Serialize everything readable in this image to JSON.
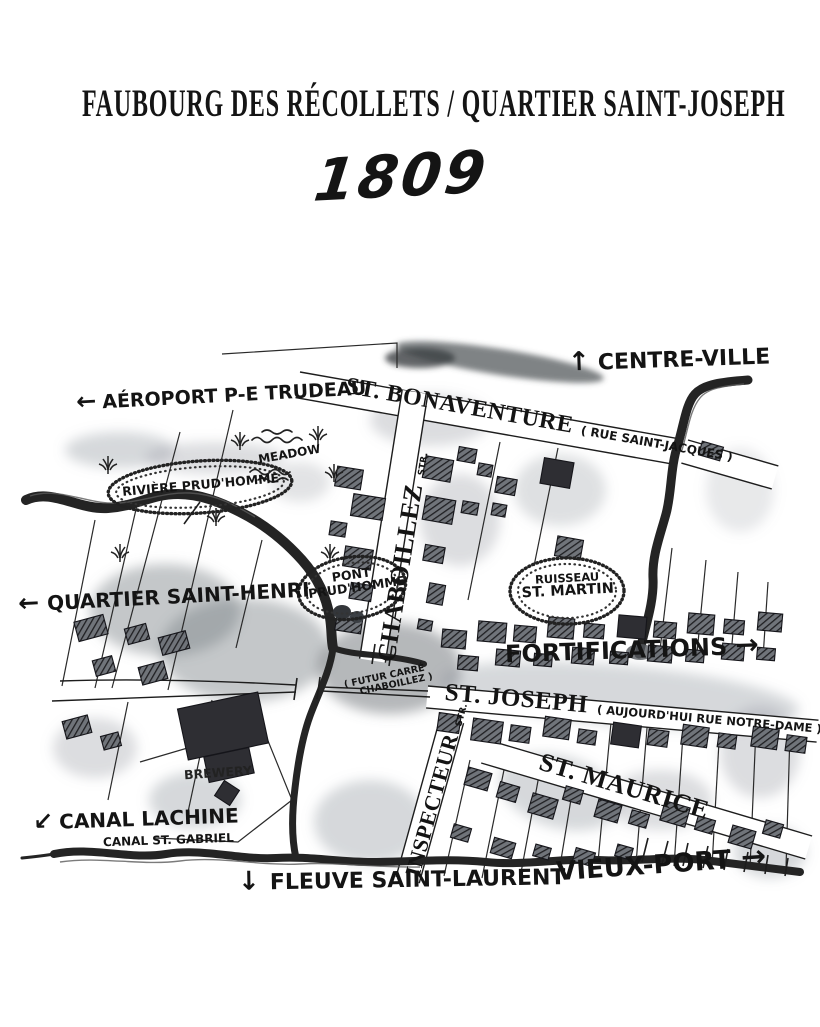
{
  "page": {
    "background": "#ffffff",
    "ink": "#141414",
    "wash": "#8a9097"
  },
  "header": {
    "title": "FAUBOURG DES RÉCOLLETS / QUARTIER SAINT-JOSEPH",
    "year": "1809"
  },
  "map": {
    "directions": [
      {
        "id": "centre-ville",
        "arrow": "↑",
        "text": "CENTRE-VILLE"
      },
      {
        "id": "aeroport",
        "arrow": "←",
        "text": "AÉROPORT P-E TRUDEAU"
      },
      {
        "id": "quartier-saint-henri",
        "arrow": "←",
        "text": "QUARTIER SAINT-HENRI"
      },
      {
        "id": "fortifications",
        "arrow": "→",
        "text": "FORTIFICATIONS"
      },
      {
        "id": "canal-lachine",
        "arrow": "↙",
        "text": "CANAL LACHINE"
      },
      {
        "id": "fleuve-saint-laurent",
        "arrow": "↓",
        "text": "FLEUVE SAINT-LAURENT"
      },
      {
        "id": "vieux-port",
        "arrow": "→",
        "text": "VIEUX-PORT"
      }
    ],
    "streets": {
      "bonaventure": {
        "name": "ST. BONAVENTURE",
        "note": "( RUE SAINT-JACQUES )"
      },
      "chaboillez": {
        "name": "CHABOILLEZ",
        "suffix": "STR."
      },
      "st_joseph": {
        "name": "ST. JOSEPH",
        "note": "( AUJOURD'HUI RUE NOTRE-DAME )"
      },
      "inspecteur": {
        "name": "INSPECTEUR",
        "suffix": "STR."
      },
      "st_maurice": {
        "name": "ST. MAURICE"
      }
    },
    "features": {
      "meadow": "MEADOW",
      "riviere": "RIVIÈRE PRUD'HOMME",
      "pont_line1": "PONT",
      "pont_line2": "PRUD'HOMME",
      "ruisseau_line1": "RUISSEAU",
      "ruisseau_line2": "ST. MARTIN",
      "futur_line1": "( FUTUR CARRÉ",
      "futur_line2": "CHABOILLEZ )",
      "brewery": "BREWERY",
      "canal_st_gabriel": "CANAL ST. GABRIEL"
    }
  }
}
